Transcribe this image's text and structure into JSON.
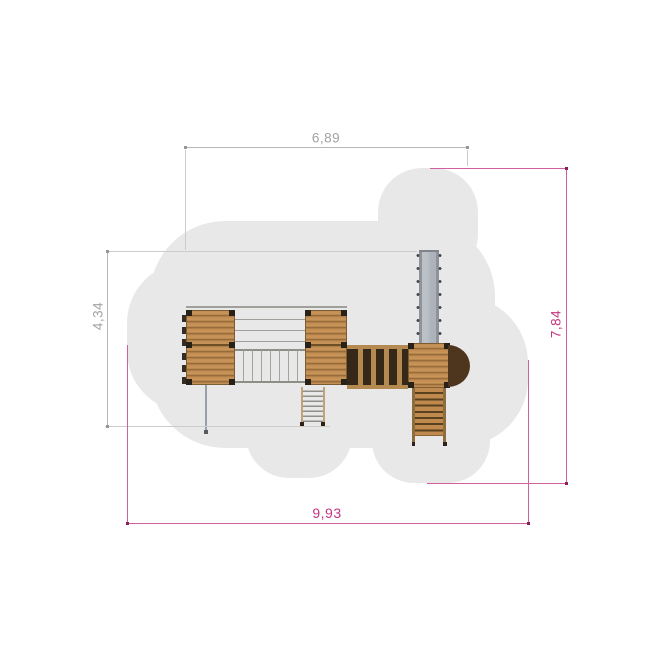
{
  "drawing": {
    "dimensions": {
      "top": {
        "label": "6,89"
      },
      "left": {
        "label": "4,34"
      },
      "right": {
        "label": "7,84"
      },
      "bottom": {
        "label": "9,93"
      }
    },
    "colors": {
      "dimension_gray_text": "#a3a3a3",
      "dimension_gray_line": "#b7b7b7",
      "dimension_pink_text": "#c53580",
      "dimension_pink_line": "#d0619f",
      "safety_zone_fill": "#e9e8e8",
      "wood_plank": "#c28d53",
      "wood_dark_panel": "#352818",
      "slide_metal": "#aeb2ba",
      "background": "#ffffff"
    }
  }
}
